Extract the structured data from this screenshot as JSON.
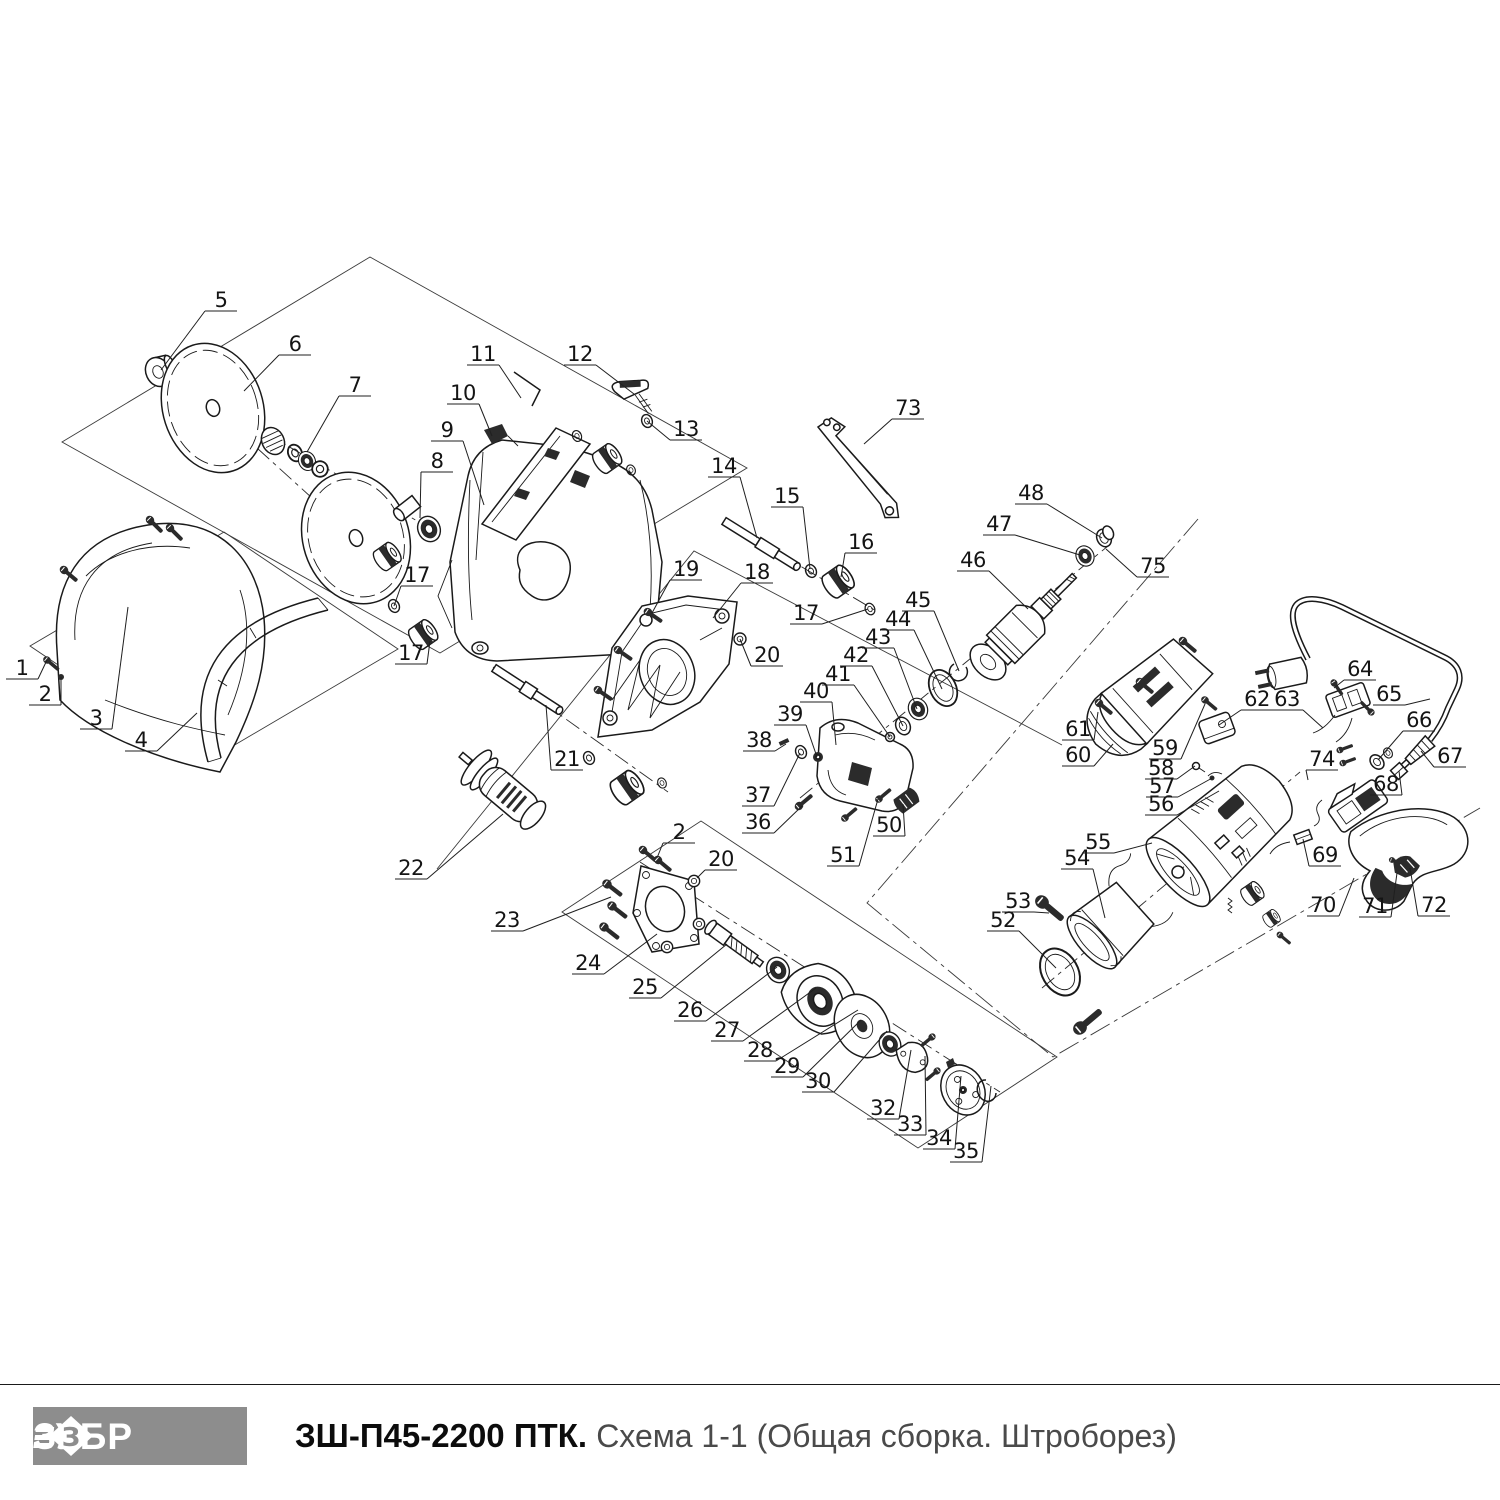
{
  "footer": {
    "logo_text": "ЗУБР",
    "model": "ЗШ-П45-2200 ПТК. ",
    "scheme": "Схема 1-1 (Общая сборка. Штроборез)"
  },
  "colors": {
    "line": "#1a1a1a",
    "logo_bg": "#8d8d8d",
    "scheme_text": "#4a4a4a",
    "dark_fill": "#2b2b2b"
  },
  "diagram": {
    "type": "exploded-parts-schematic",
    "parts": [
      {
        "n": "1",
        "x": 22,
        "y": 671,
        "tx": 47,
        "ty": 660
      },
      {
        "n": "2",
        "x": 45,
        "y": 697,
        "tx": 61,
        "ty": 677
      },
      {
        "n": "3",
        "x": 96,
        "y": 721,
        "tx": 128,
        "ty": 607
      },
      {
        "n": "4",
        "x": 141,
        "y": 743,
        "tx": 197,
        "ty": 713
      },
      {
        "n": "5",
        "x": 221,
        "y": 303,
        "tx": 161,
        "ty": 370
      },
      {
        "n": "6",
        "x": 295,
        "y": 347,
        "tx": 244,
        "ty": 391
      },
      {
        "n": "7",
        "x": 355,
        "y": 388,
        "tx": 307,
        "ty": 452
      },
      {
        "n": "8",
        "x": 437,
        "y": 464,
        "tx": 420,
        "ty": 518
      },
      {
        "n": "9",
        "x": 447,
        "y": 433,
        "tx": 484,
        "ty": 505
      },
      {
        "n": "10",
        "x": 463,
        "y": 396,
        "tx": 492,
        "ty": 436
      },
      {
        "n": "11",
        "x": 483,
        "y": 357,
        "tx": 521,
        "ty": 398
      },
      {
        "n": "12",
        "x": 580,
        "y": 357,
        "tx": 634,
        "ty": 394
      },
      {
        "n": "13",
        "x": 686,
        "y": 432,
        "tx": 647,
        "ty": 421
      },
      {
        "n": "14",
        "x": 724,
        "y": 469,
        "tx": 757,
        "ty": 538
      },
      {
        "n": "15",
        "x": 787,
        "y": 499,
        "tx": 810,
        "ty": 569
      },
      {
        "n": "16",
        "x": 861,
        "y": 545,
        "tx": 841,
        "ty": 577
      },
      {
        "n": "17",
        "x": 417,
        "y": 578,
        "tx": 394,
        "ty": 606
      },
      {
        "n": "17",
        "x": 411,
        "y": 656,
        "tx": 430,
        "ty": 641
      },
      {
        "n": "17",
        "x": 806,
        "y": 616,
        "tx": 868,
        "ty": 609
      },
      {
        "n": "18",
        "x": 757,
        "y": 575,
        "tx": 713,
        "ty": 618
      },
      {
        "n": "19",
        "x": 686,
        "y": 572,
        "tx": 652,
        "ty": 613
      },
      {
        "n": "20",
        "x": 767,
        "y": 658,
        "tx": 740,
        "ty": 639
      },
      {
        "n": "21",
        "x": 567,
        "y": 762,
        "tx": 546,
        "ty": 705
      },
      {
        "n": "22",
        "x": 411,
        "y": 871,
        "tx": 503,
        "ty": 814
      },
      {
        "n": "23",
        "x": 507,
        "y": 923,
        "tx": 611,
        "ty": 897
      },
      {
        "n": "24",
        "x": 588,
        "y": 966,
        "tx": 657,
        "ty": 934
      },
      {
        "n": "25",
        "x": 645,
        "y": 990,
        "tx": 727,
        "ty": 944
      },
      {
        "n": "26",
        "x": 690,
        "y": 1013,
        "tx": 777,
        "ty": 967
      },
      {
        "n": "27",
        "x": 727,
        "y": 1033,
        "tx": 816,
        "ty": 988
      },
      {
        "n": "28",
        "x": 760,
        "y": 1053,
        "tx": 858,
        "ty": 1010
      },
      {
        "n": "29",
        "x": 787,
        "y": 1069,
        "tx": 861,
        "ty": 1020
      },
      {
        "n": "30",
        "x": 818,
        "y": 1084,
        "tx": 887,
        "ty": 1031
      },
      {
        "n": "32",
        "x": 883,
        "y": 1111,
        "tx": 911,
        "ty": 1050
      },
      {
        "n": "33",
        "x": 910,
        "y": 1127,
        "tx": 925,
        "ty": 1056
      },
      {
        "n": "34",
        "x": 939,
        "y": 1141,
        "tx": 961,
        "ty": 1076
      },
      {
        "n": "35",
        "x": 966,
        "y": 1154,
        "tx": 991,
        "ty": 1086
      },
      {
        "n": "36",
        "x": 758,
        "y": 825,
        "tx": 802,
        "ty": 806
      },
      {
        "n": "37",
        "x": 758,
        "y": 798,
        "tx": 800,
        "ty": 753
      },
      {
        "n": "38",
        "x": 759,
        "y": 743,
        "tx": 786,
        "ty": 744
      },
      {
        "n": "39",
        "x": 790,
        "y": 717,
        "tx": 817,
        "ty": 757
      },
      {
        "n": "40",
        "x": 816,
        "y": 694,
        "tx": 836,
        "ty": 745
      },
      {
        "n": "41",
        "x": 838,
        "y": 677,
        "tx": 890,
        "ty": 737
      },
      {
        "n": "42",
        "x": 856,
        "y": 658,
        "tx": 903,
        "ty": 726
      },
      {
        "n": "43",
        "x": 878,
        "y": 640,
        "tx": 917,
        "ty": 709
      },
      {
        "n": "44",
        "x": 898,
        "y": 622,
        "tx": 942,
        "ty": 689
      },
      {
        "n": "45",
        "x": 918,
        "y": 603,
        "tx": 959,
        "ty": 671
      },
      {
        "n": "46",
        "x": 973,
        "y": 563,
        "tx": 1028,
        "ty": 609
      },
      {
        "n": "47",
        "x": 999,
        "y": 527,
        "tx": 1080,
        "ty": 555
      },
      {
        "n": "48",
        "x": 1031,
        "y": 496,
        "tx": 1102,
        "ty": 538
      },
      {
        "n": "50",
        "x": 889,
        "y": 828,
        "tx": 903,
        "ty": 804
      },
      {
        "n": "51",
        "x": 843,
        "y": 858,
        "tx": 878,
        "ty": 799
      },
      {
        "n": "2",
        "x": 679,
        "y": 835,
        "tx": 657,
        "ty": 858
      },
      {
        "n": "20",
        "x": 721,
        "y": 862,
        "tx": 697,
        "ty": 878
      },
      {
        "n": "52",
        "x": 1003,
        "y": 923,
        "tx": 1056,
        "ty": 968
      },
      {
        "n": "53",
        "x": 1018,
        "y": 904,
        "tx": 1049,
        "ty": 913
      },
      {
        "n": "54",
        "x": 1077,
        "y": 861,
        "tx": 1105,
        "ty": 918
      },
      {
        "n": "55",
        "x": 1098,
        "y": 845,
        "tx": 1152,
        "ty": 843
      },
      {
        "n": "56",
        "x": 1161,
        "y": 807,
        "tx": 1219,
        "ty": 791
      },
      {
        "n": "57",
        "x": 1162,
        "y": 789,
        "tx": 1214,
        "ty": 777
      },
      {
        "n": "58",
        "x": 1161,
        "y": 771,
        "tx": 1195,
        "ty": 766
      },
      {
        "n": "59",
        "x": 1165,
        "y": 751,
        "tx": 1205,
        "ty": 704
      },
      {
        "n": "60",
        "x": 1078,
        "y": 758,
        "tx": 1113,
        "ty": 744
      },
      {
        "n": "61",
        "x": 1078,
        "y": 732,
        "tx": 1098,
        "ty": 712
      },
      {
        "n": "62",
        "x": 1257,
        "y": 702,
        "tx": 1219,
        "ty": 725
      },
      {
        "n": "63",
        "x": 1287,
        "y": 702,
        "tx": 1323,
        "ty": 728
      },
      {
        "n": "64",
        "x": 1360,
        "y": 672,
        "tx": 1334,
        "ty": 688
      },
      {
        "n": "65",
        "x": 1389,
        "y": 697,
        "tx": 1430,
        "ty": 699
      },
      {
        "n": "66",
        "x": 1419,
        "y": 723,
        "tx": 1378,
        "ty": 760
      },
      {
        "n": "67",
        "x": 1450,
        "y": 759,
        "tx": 1421,
        "ty": 751
      },
      {
        "n": "68",
        "x": 1386,
        "y": 787,
        "tx": 1399,
        "ty": 771
      },
      {
        "n": "69",
        "x": 1325,
        "y": 858,
        "tx": 1303,
        "ty": 839
      },
      {
        "n": "70",
        "x": 1323,
        "y": 908,
        "tx": 1354,
        "ty": 878
      },
      {
        "n": "71",
        "x": 1375,
        "y": 909,
        "tx": 1397,
        "ty": 873
      },
      {
        "n": "72",
        "x": 1434,
        "y": 908,
        "tx": 1410,
        "ty": 868
      },
      {
        "n": "73",
        "x": 908,
        "y": 411,
        "tx": 864,
        "ty": 444
      },
      {
        "n": "74",
        "x": 1322,
        "y": 762,
        "tx": 1308,
        "ty": 780
      },
      {
        "n": "75",
        "x": 1153,
        "y": 569,
        "tx": 1106,
        "ty": 549
      }
    ]
  }
}
